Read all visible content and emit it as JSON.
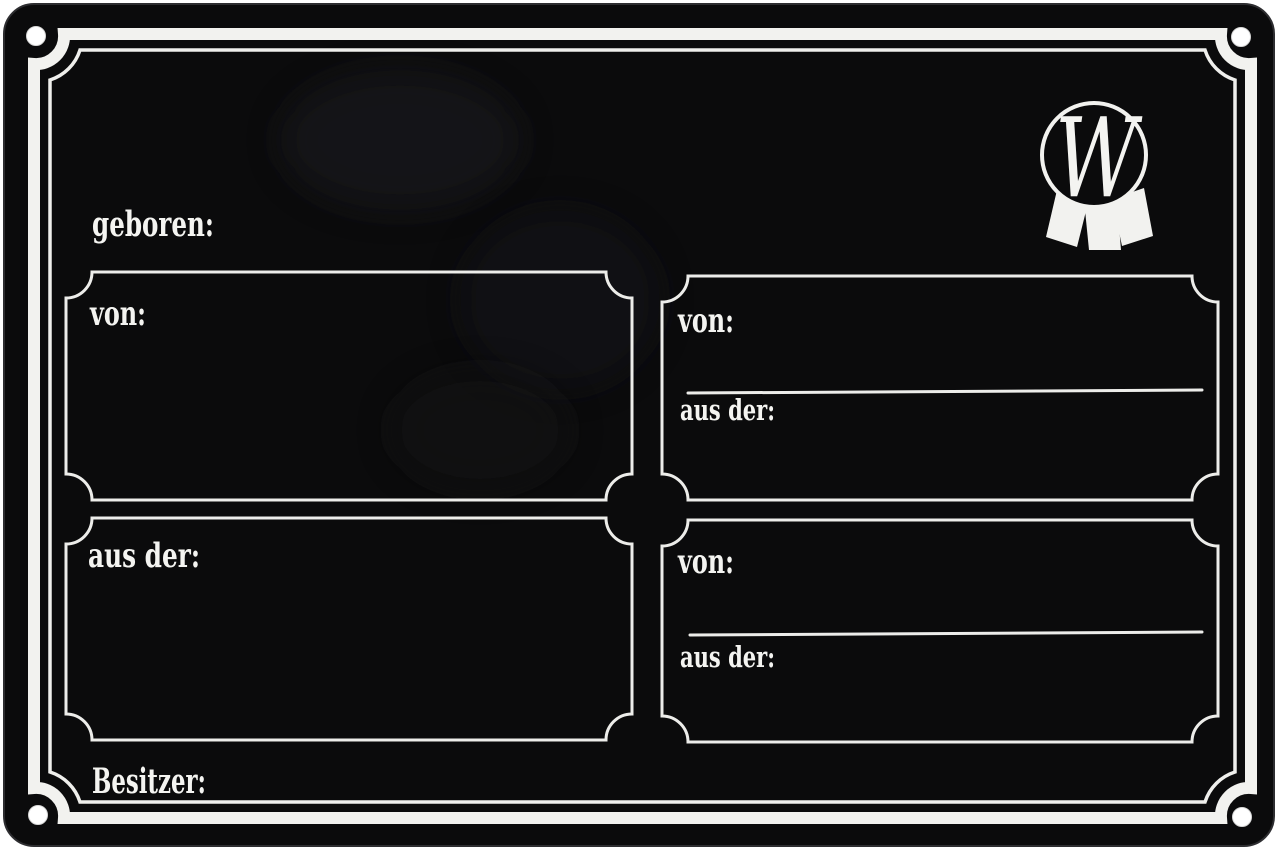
{
  "colors": {
    "background": "#ffffff",
    "plate": "#0b0b0c",
    "ink": "#f4f4f1"
  },
  "sign": {
    "type": "blank pedigree stable plaque",
    "born_label": "geboren:",
    "owner_label": "Besitzer:",
    "panels": {
      "top_left": {
        "label": "von:"
      },
      "top_right": {
        "von_label": "von:",
        "aus_der_label": "aus der:"
      },
      "bottom_left": {
        "label": "aus der:"
      },
      "bottom_right": {
        "von_label": "von:",
        "aus_der_label": "aus der:"
      }
    },
    "logo": {
      "letter": "W",
      "icon": "rosette-ribbon-badge"
    }
  }
}
